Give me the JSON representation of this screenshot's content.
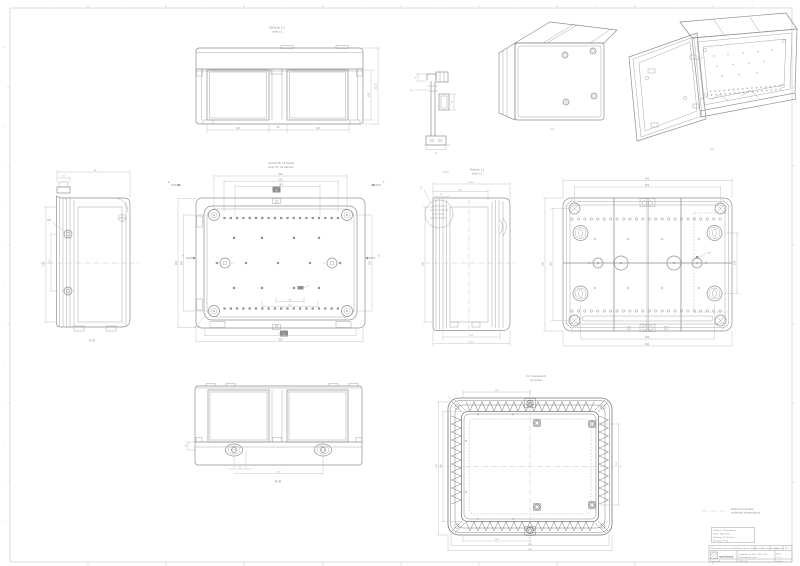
{
  "sheet": {
    "frame_cols": [
      "1",
      "2",
      "3",
      "4",
      "5",
      "6",
      "7",
      "8",
      "9",
      "10"
    ],
    "frame_rows": [
      "A",
      "B",
      "C",
      "D",
      "E",
      "F",
      "G"
    ]
  },
  "views": {
    "front": {
      "title1": "Maßstab 1:2",
      "title2": "scale 1:2",
      "dim_w1": "110",
      "dim_gap": "20",
      "dim_w2": "110",
      "dim_h": "100",
      "dim_h2": "111.5"
    },
    "hinge": {
      "d1": "8",
      "d2": "3.5",
      "d3": "16",
      "d4": "12"
    },
    "iso_closed": {
      "scale": "1:4"
    },
    "iso_open": {
      "scale": "1:4"
    },
    "side": {
      "label": "E-E",
      "d_top1": "24",
      "d_top2": "96",
      "d_left1": "230",
      "d_left2": "114",
      "lead": "M6"
    },
    "plan": {
      "title1": "Ansicht TB: mit Deckel",
      "title2": "ohne Tür, mit Rahmen",
      "m_a": "A",
      "m_b": "B",
      "m_c": "C",
      "m_d": "D",
      "m_e": "E",
      "m_f": "F",
      "d_top1": "254",
      "d_top2": "220",
      "d_top3": "180",
      "d_left1": "230",
      "d_left2": "200",
      "d_right1": "200",
      "d_bot1": "270",
      "d_bot2": "300",
      "d_in1": "40",
      "d_in2": "112",
      "lead": "ø4.2"
    },
    "section": {
      "label": "C-C",
      "scale1": "Maßstab 1:2",
      "scale2": "scale 1:2",
      "z": "Z",
      "d_top1": "111.5",
      "d_top2": "104",
      "d_top3": "13",
      "d_left": "230",
      "d_bot1": "104",
      "d_bot2": "111.5"
    },
    "bottom": {
      "d_top1": "300",
      "d_top2": "254",
      "d_left1": "230",
      "d_left2": "200",
      "d_right1": "104",
      "d_bot1": "230",
      "d_bot2": "300",
      "lead": "M4"
    },
    "rear": {
      "label": "B-B",
      "d1": "14",
      "d2": "22",
      "d3": "152"
    },
    "gasket": {
      "title1": "CA: Innenansicht",
      "title2": "der Haube",
      "d_top": "120",
      "d_left1": "200",
      "d_left2": "230",
      "d_right": "152",
      "d_bot1": "120",
      "d_bot2": "280",
      "d_bot3": "300"
    }
  },
  "notes": {
    "leader1": "Dichtung im Deckel",
    "leader2": "umlaufend eingeschäumt",
    "box1": "Gehäuse: Polycarbonat",
    "box2": "Farbe: RAL 7035",
    "box3": "Dichtung: PU-Schaum",
    "box4": "Schutzart IP 66"
  },
  "title_block": {
    "protect": "Weitergabe sowie Vervielfältigung dieses Dokuments nur mit Genehmigung",
    "scale": "1:2",
    "format": "A3",
    "sheet": "Bl. 1",
    "brand": "spelsberg",
    "product1": "Leergehäuse 300 x 230 x 111",
    "product2": "Polycarbonat, grau",
    "right1": "Blatt",
    "right2": "1 v. 1",
    "no_label": "Zeichn.-Nr.",
    "number": "10601301",
    "index": "Index c"
  }
}
